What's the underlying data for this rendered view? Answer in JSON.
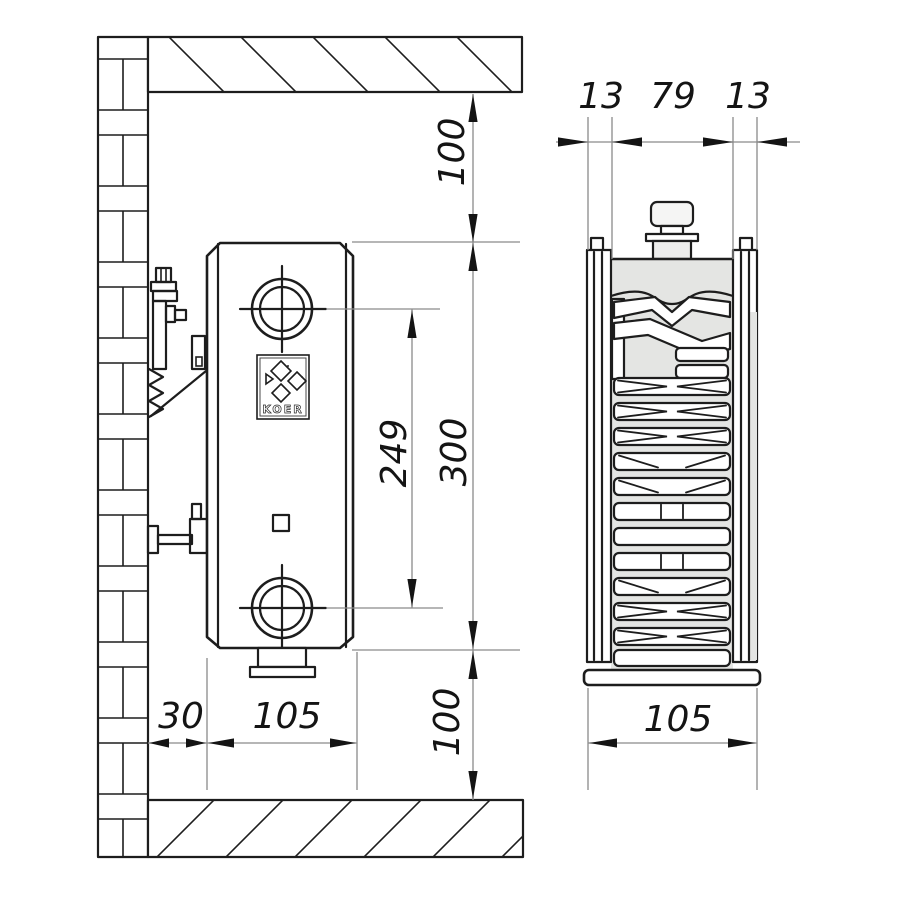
{
  "drawing": {
    "brand_logo": "KOER",
    "side_view": {
      "label": "radiator side installation view",
      "dims": {
        "ceiling_gap": "100",
        "radiator_height": "300",
        "pipe_spacing": "249",
        "floor_gap": "100",
        "wall_gap": "30",
        "depth": "105"
      }
    },
    "section_view": {
      "label": "radiator cross-section view",
      "dims": {
        "front_panel": "13",
        "core_width": "79",
        "back_panel": "13",
        "depth": "105"
      }
    },
    "colors": {
      "line": "#1d1d1d",
      "thin_line": "#8a8a8a",
      "metal_fill": "#e4e5e3",
      "background": "#ffffff"
    }
  }
}
